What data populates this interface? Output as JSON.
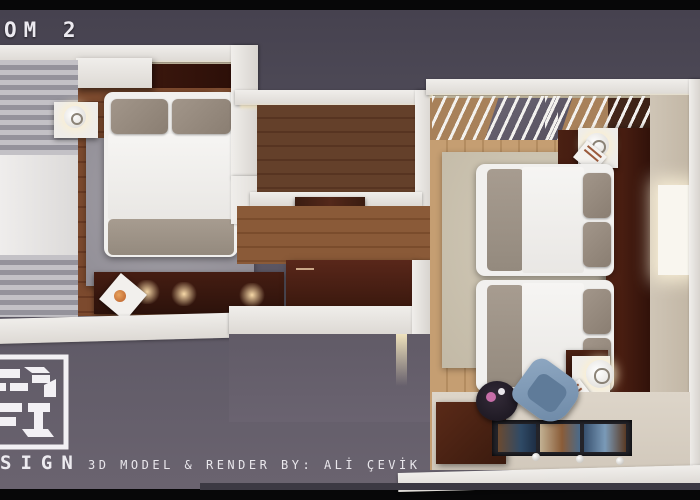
{
  "scene": {
    "title": "OM 2",
    "credit": "3D MODEL & RENDER BY: ALİ ÇEVİK",
    "logo_text": "SIGN",
    "description": "Top-down 3D render of a two-bedroom hotel room floor plan",
    "objects": [
      "left-bedroom: double bed, two nightstands with lamps, window curtains, low console with spotlights, gray rug",
      "entry-vestibule: dark wood door, corridor, dark dresser",
      "right-bedroom: two twin beds, headboard wall in dark mahogany, nightstands with lamps, beige rug, louvered ceiling slats, desk with glass display, blue chair, round stool, glowing wall panel"
    ],
    "colors": {
      "background": "#56525f",
      "letterbox": "#070708",
      "wall_white": "#f0eeeb",
      "wood_left": "#7c4a2e",
      "wood_right": "#c59e72",
      "headboard_mahogany": "#3a1a10",
      "rug_left": "#9a97a0",
      "rug_right": "#cdc5b2",
      "pillow_gray": "#95897d",
      "chair_blue": "#7f9ab7",
      "glow_warm": "#f6e7bd"
    }
  }
}
